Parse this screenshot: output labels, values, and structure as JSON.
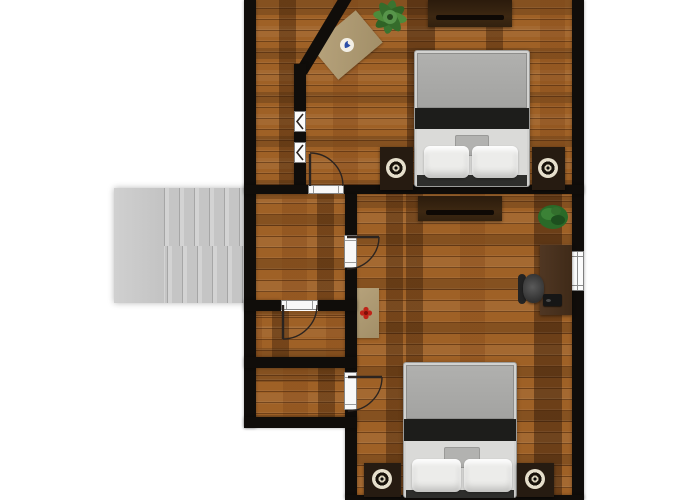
{
  "scene": {
    "kind": "2d-floor-plan-top-view",
    "floor_texture": "wood-planks",
    "background": "#ffffff",
    "visible_text": ""
  },
  "palette": {
    "wall": "#100d0a",
    "floor_wood": "#9f6126",
    "floor_wood_dark_streak": "#4f2e10",
    "stairs_gray": "#c9c9c9",
    "bed_blanket_gray": "#a7a7a5",
    "bed_band_black": "#1d1d1b",
    "bed_linen_white": "#ececea",
    "dark_wood_furniture": "#33210f",
    "rug_tan": "#ae9b76",
    "plant_green": "#3f7a33",
    "desk_brown": "#4b3322",
    "door_sill_white": "#f8f8f8",
    "rug_emblem_red": "#bf2318",
    "rug_emblem_blue": "#2b4ea8"
  },
  "rooms": [
    {
      "id": "bedroom-north",
      "features": [
        "diagonal-corner-wall",
        "interior-window",
        "interior-window",
        "door-to-hallway"
      ],
      "furniture": [
        "dresser",
        "potted-plant",
        "angled-area-rug-with-blue-logo",
        "double-bed",
        "nightstand-with-lamp",
        "nightstand-with-lamp"
      ]
    },
    {
      "id": "bedroom-south",
      "features": [
        "exterior-window-right-wall",
        "door-from-hallway",
        "door-near-closet"
      ],
      "furniture": [
        "dresser",
        "potted-plant",
        "desk",
        "office-chair",
        "laptop",
        "area-rug-with-red-emblem",
        "double-bed",
        "nightstand-with-lamp",
        "nightstand-with-lamp"
      ]
    },
    {
      "id": "hallway",
      "features": [
        "open-to-staircase"
      ]
    },
    {
      "id": "closet-upper",
      "features": [
        "door-from-hallway"
      ]
    },
    {
      "id": "closet-lower",
      "features": [
        "door-to-bedroom-south"
      ]
    },
    {
      "id": "staircase",
      "flights": 2,
      "treads_per_flight": 6,
      "landing": "left"
    }
  ],
  "doors": [
    {
      "id": "door-bedroom-north",
      "swing": "opens-north-into-bedroom",
      "hinge": "left"
    },
    {
      "id": "door-bedroom-south-upper",
      "swing": "opens-east-into-bedroom",
      "hinge": "top"
    },
    {
      "id": "door-closet-upper",
      "swing": "opens-south-into-closet",
      "hinge": "left"
    },
    {
      "id": "door-bedroom-south-lower",
      "swing": "opens-east-into-bedroom",
      "hinge": "top"
    }
  ],
  "windows": [
    {
      "id": "interior-window-1",
      "wall": "corridor-bedroom-north"
    },
    {
      "id": "interior-window-2",
      "wall": "corridor-bedroom-north"
    },
    {
      "id": "exterior-window-right",
      "wall": "east"
    }
  ],
  "counts": {
    "beds": 2,
    "nightstands": 4,
    "lamps": 4,
    "dressers": 2,
    "plants": 2,
    "rugs": 2,
    "doors": 4,
    "windows": 3
  }
}
